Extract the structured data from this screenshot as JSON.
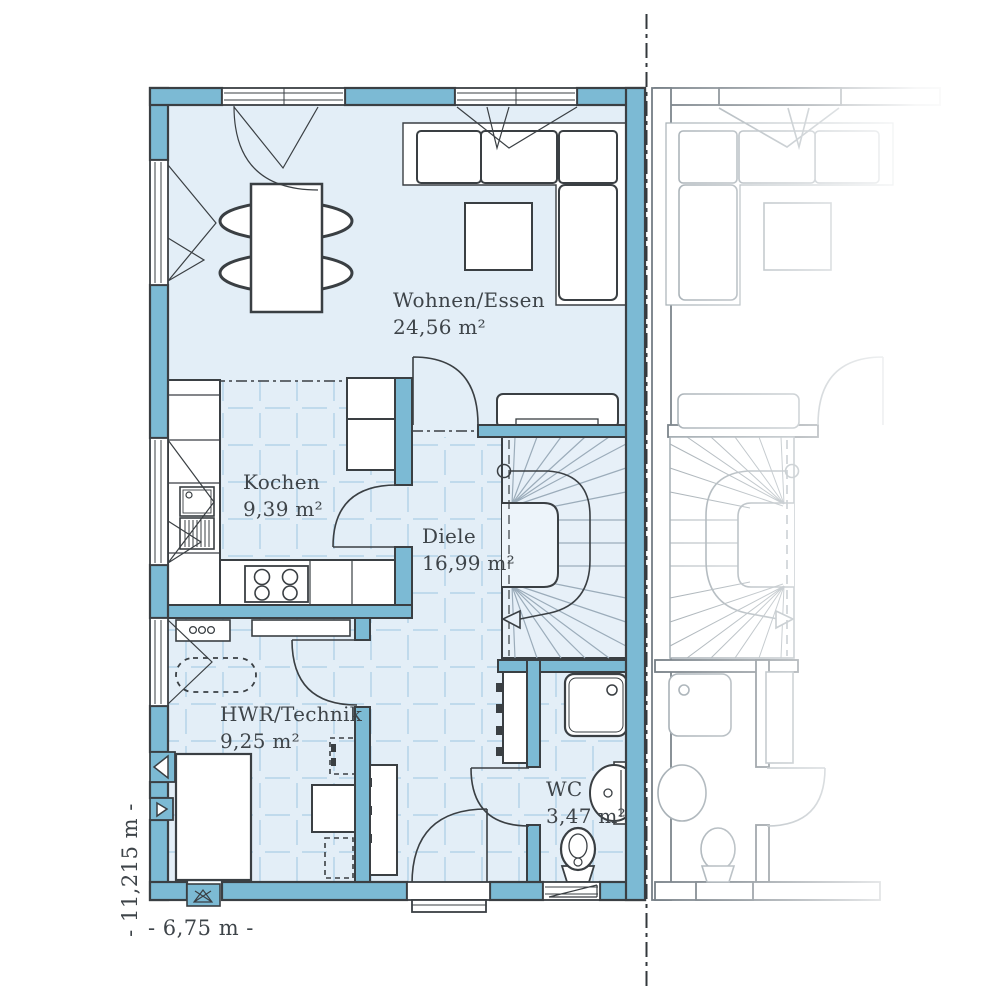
{
  "rooms": {
    "wohnen": {
      "name": "Wohnen/Essen",
      "area": "24,56 m²"
    },
    "kochen": {
      "name": "Kochen",
      "area": "9,39 m²"
    },
    "diele": {
      "name": "Diele",
      "area": "16,99 m²"
    },
    "hwr": {
      "name": "HWR/Technik",
      "area": "9,25 m²"
    },
    "wc": {
      "name": "WC",
      "area": "3,47 m²"
    }
  },
  "dimensions": {
    "height": "- 11,215 m -",
    "width": "- 6,75 m -"
  },
  "colors": {
    "wall": "#7CBAD4",
    "outline": "#3A3F43",
    "floor": "#E3EEF7",
    "tile_line": "#BBD7EA",
    "neighbor_line": "#A5AEB4",
    "text": "#3E4449"
  }
}
